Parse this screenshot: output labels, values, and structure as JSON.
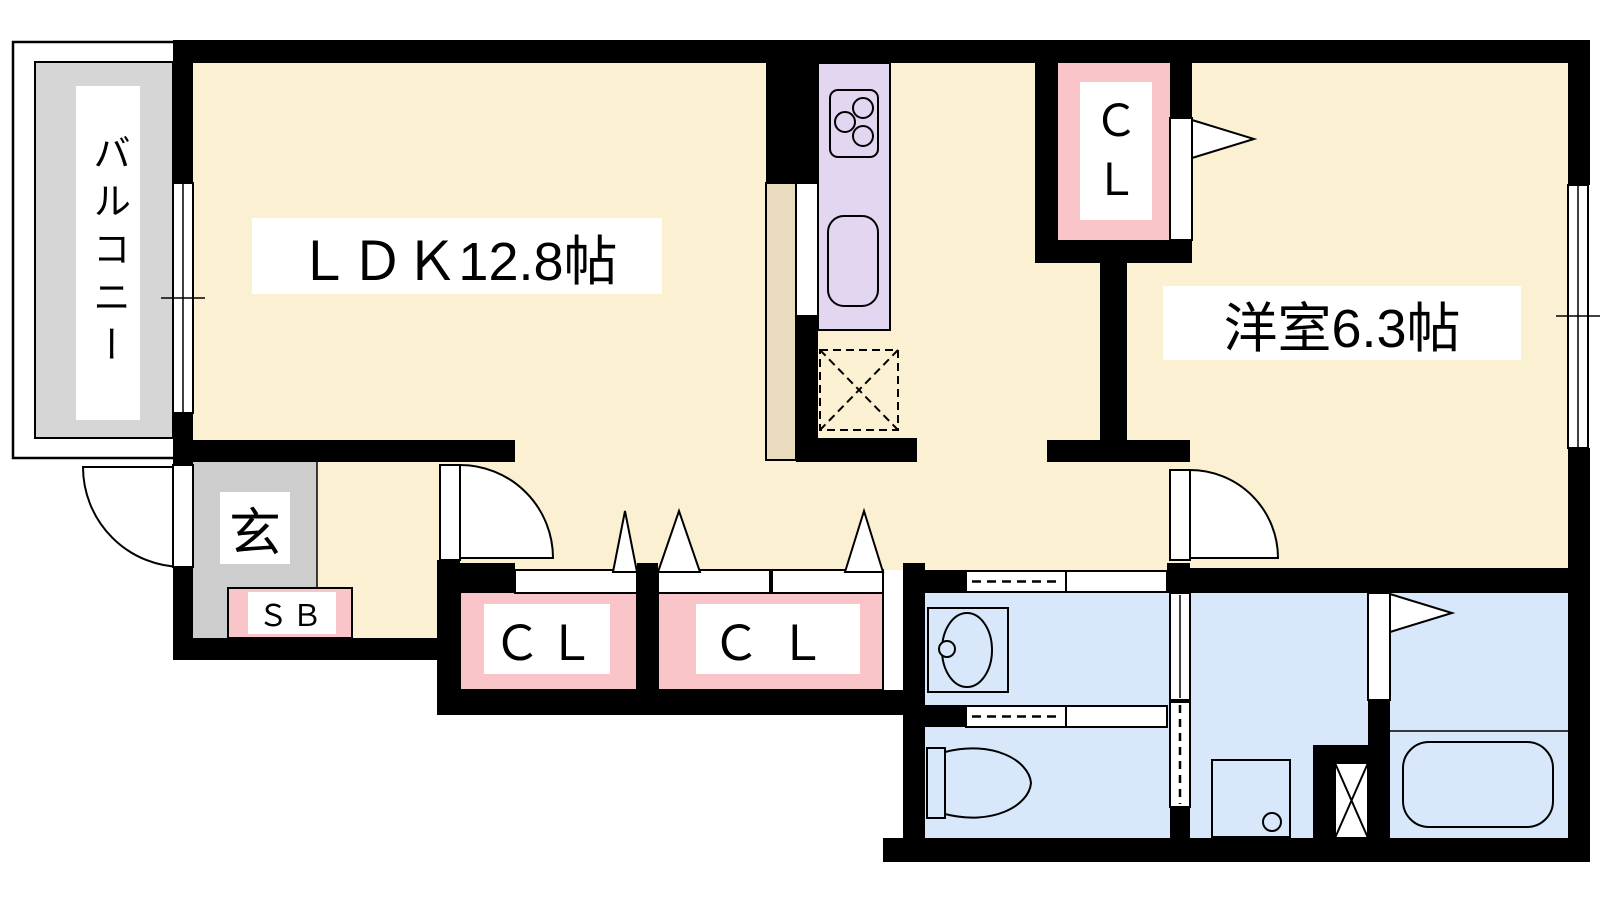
{
  "floor_plan": {
    "title": "1LDK apartment floor plan",
    "labels": {
      "balcony": "バルコニー",
      "ldk": "ＬＤＫ12.8帖",
      "western_room": "洋室6.3帖",
      "entrance": "玄",
      "shoe_box": "ＳＢ",
      "closet_left": "ＣＬ",
      "closet_right": "ＣＬ",
      "closet_top_line1": "Ｃ",
      "closet_top_line2": "Ｌ"
    },
    "colors": {
      "room-cream": "#FBF0D2",
      "kitchen-lavender": "#E2D6F0",
      "closet-pink": "#FAC5C9",
      "wet-blue": "#D8E8FA",
      "balcony-gray": "#D6D6D6",
      "entrance-gray": "#CDCDCD",
      "counter-tan": "#E9DCBE",
      "wall-black": "#000000"
    },
    "fixtures": [
      "stove",
      "kitchen-sink",
      "refrigerator-space",
      "counter",
      "washbasin",
      "toilet",
      "washing-machine-pan",
      "bathtub",
      "pipe-space"
    ]
  }
}
